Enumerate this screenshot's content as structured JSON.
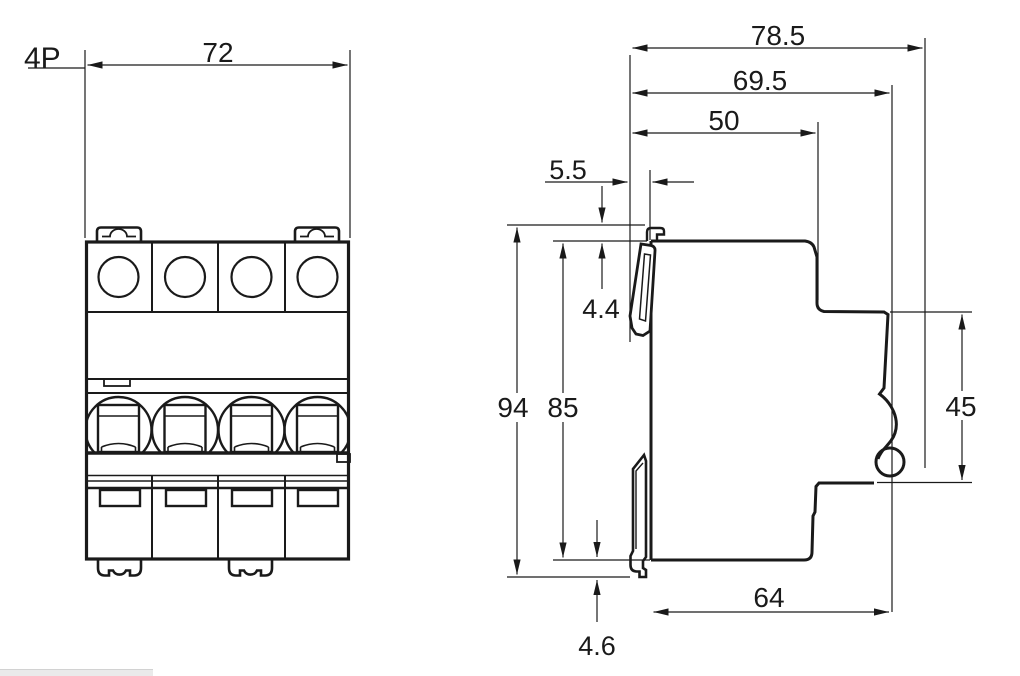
{
  "labels": {
    "pole_count": "4P",
    "front_width": "72",
    "overall_depth": "78.5",
    "depth_excl_toggle": "69.5",
    "upper_depth": "50",
    "toggle_protrusion": "5.5",
    "top_offset": "4.4",
    "overall_height": "94",
    "body_height": "85",
    "recess_height": "45",
    "lower_depth": "64",
    "bottom_offset": "4.6"
  },
  "colors": {
    "line": "#1a1a1a",
    "background": "#ffffff",
    "footer_bar": "#eaeaea"
  }
}
